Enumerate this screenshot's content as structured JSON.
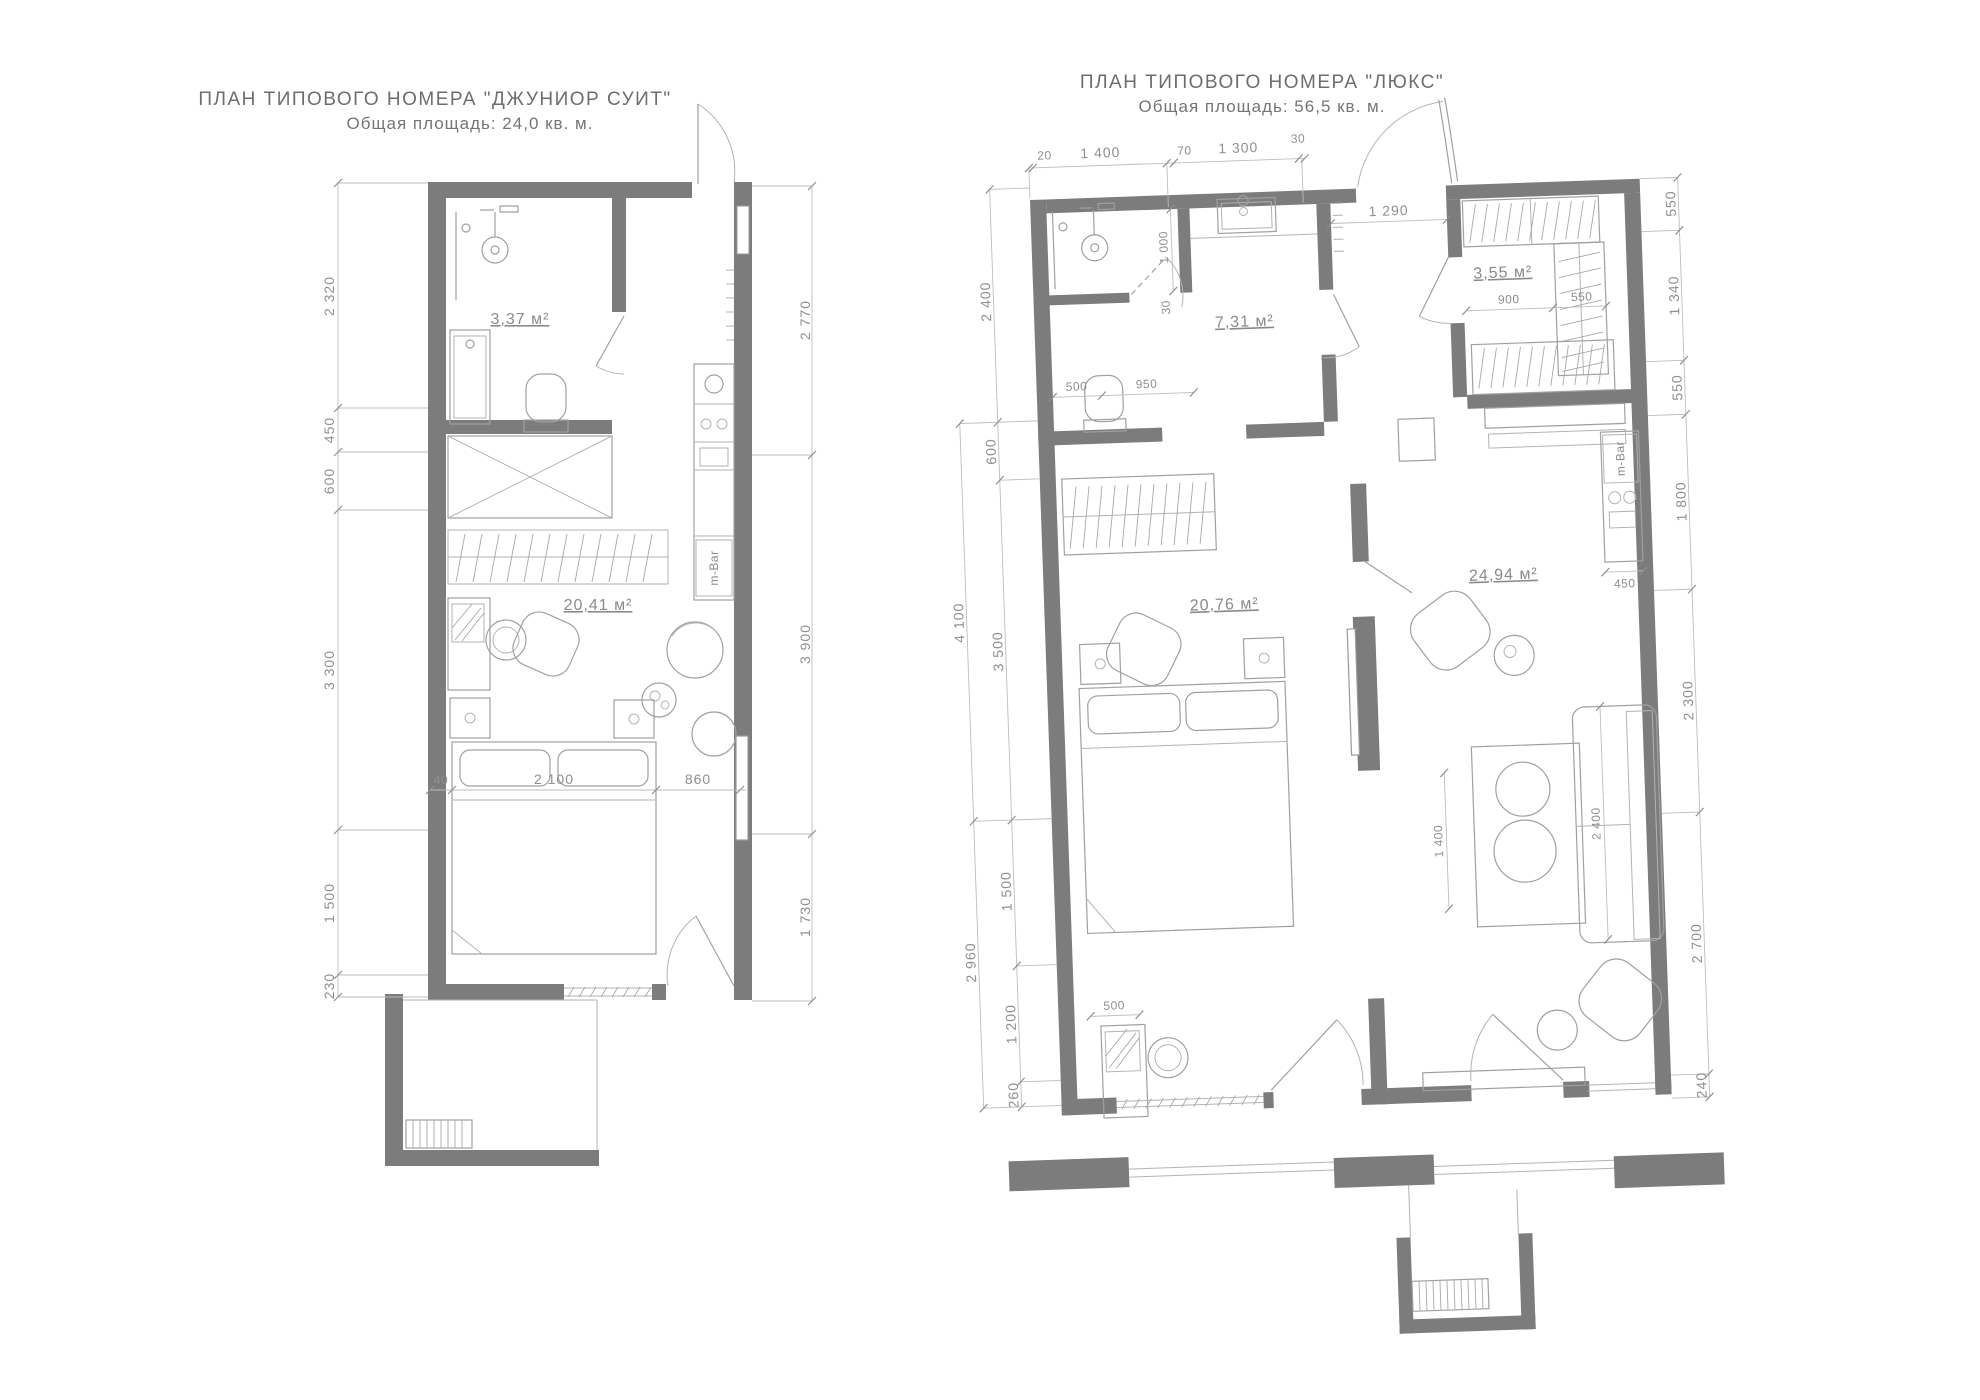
{
  "colors": {
    "wall": "#7c7c7c",
    "furniture_line": "#a0a0a0",
    "dim_text": "#8f8f8f",
    "title_text": "#6d6d6d"
  },
  "plans": [
    {
      "name": "junior-suite",
      "title": "ПЛАН  ТИПОВОГО НОМЕРА \"ДЖУНИОР СУИТ\"",
      "subtitle": "Общая площадь: 24,0 кв. м.",
      "areas": {
        "bathroom": "3,37 м²",
        "room": "20,41 м²"
      },
      "minibar_label": "m-Bar",
      "dims": {
        "left": [
          "2 320",
          "450",
          "600",
          "3 300",
          "1 500",
          "230"
        ],
        "right": [
          "2 770",
          "3 900",
          "1 730"
        ],
        "inner": [
          "40",
          "2 100",
          "860"
        ]
      }
    },
    {
      "name": "lux",
      "title": "ПЛАН  ТИПОВОГО НОМЕРА \"ЛЮКС\"",
      "subtitle": "Общая площадь: 56,5 кв. м.",
      "areas": {
        "bathroom": "7,31 м²",
        "wardrobe": "3,55 м²",
        "bedroom": "20,76 м²",
        "living": "24,94 м²"
      },
      "minibar_label": "m-Bar",
      "dims": {
        "top": [
          "20",
          "1 400",
          "70",
          "1 300",
          "30"
        ],
        "entry": "1 290",
        "left_inner": [
          "2 400",
          "600",
          "3 500",
          "1 500",
          "1 200",
          "260"
        ],
        "left_outer": [
          "4 100",
          "2 960"
        ],
        "right": [
          "550",
          "1 340",
          "550",
          "1 800",
          "2 300",
          "2 700",
          "240"
        ],
        "bathroom": [
          "1 000",
          "30",
          "500",
          "950"
        ],
        "wardrobe": [
          "900",
          "550"
        ],
        "minibar_depth": "450",
        "living": [
          "1 400",
          "2 400"
        ],
        "desk": "500"
      }
    }
  ]
}
